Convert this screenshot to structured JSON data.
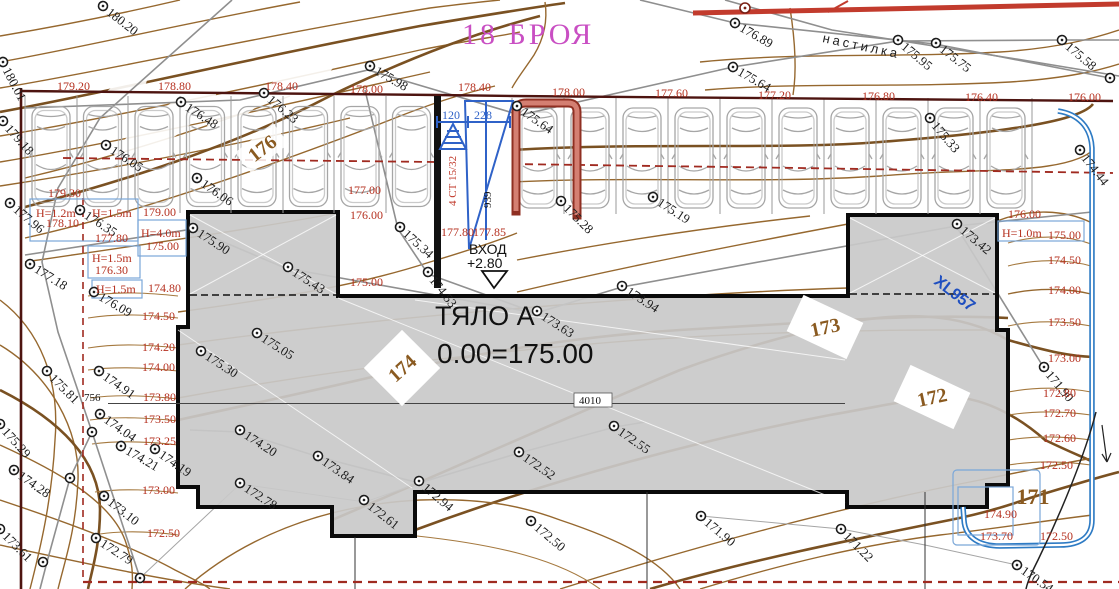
{
  "title": {
    "text": "18 БРОЯ"
  },
  "building": {
    "name": "ТЯЛО А",
    "level": "0.00=175.00",
    "entrance_label": "ВХОД",
    "entrance_height": "+2.80"
  },
  "paving_label": "настилка",
  "cable_label": "XL957",
  "crane": {
    "dim_left": "120",
    "dim_right": "228",
    "type_text": "4 СТ 15/32",
    "length": "939"
  },
  "dimensions": {
    "d756": "756",
    "d4010": "4010"
  },
  "colors": {
    "contour": "#96682f",
    "contour_index": "#7a5122",
    "red_label": "#b5301f",
    "boundary": "#4d1410",
    "dashed_red": "#a02a20",
    "blue": "#2f62c8",
    "pipe_blue": "#2e7bc4",
    "magenta": "#c94fc3",
    "building_fill": "#c9c9c9",
    "survey_gray": "#8f8f8f",
    "brown_label": "#8a5a20",
    "stair_red": "#c96a5a"
  },
  "index_labels": [
    {
      "t": "176",
      "x": 262,
      "y": 148,
      "r": -38,
      "fs": 20,
      "bg": "none"
    },
    {
      "t": "174",
      "x": 402,
      "y": 368,
      "r": -42,
      "fs": 20,
      "bg": "diamond45"
    },
    {
      "t": "173",
      "x": 825,
      "y": 327,
      "r": -12,
      "fs": 20,
      "bg": "diamond25"
    },
    {
      "t": "172",
      "x": 932,
      "y": 397,
      "r": -12,
      "fs": 20,
      "bg": "diamond25"
    },
    {
      "t": "171",
      "x": 1033,
      "y": 497,
      "r": 0,
      "fs": 22,
      "bg": "none"
    }
  ],
  "spot_elevations": [
    {
      "t": "180.20",
      "x": 103,
      "y": 6,
      "r": 38
    },
    {
      "t": "180.01",
      "x": 3,
      "y": 62,
      "r": 62
    },
    {
      "t": "179.18",
      "x": 3,
      "y": 121,
      "r": 48
    },
    {
      "t": "177.96",
      "x": 10,
      "y": 203,
      "r": 40
    },
    {
      "t": "177.18",
      "x": 30,
      "y": 264,
      "r": 32
    },
    {
      "t": "176.35",
      "x": 80,
      "y": 210,
      "r": 33
    },
    {
      "t": "176.09",
      "x": 94,
      "y": 292,
      "r": 30
    },
    {
      "t": "175.98",
      "x": 370,
      "y": 66,
      "r": 30
    },
    {
      "t": "176.48",
      "x": 181,
      "y": 102,
      "r": 33
    },
    {
      "t": "176.23",
      "x": 264,
      "y": 93,
      "r": 40
    },
    {
      "t": "176.05",
      "x": 106,
      "y": 145,
      "r": 33
    },
    {
      "t": "176.06",
      "x": 197,
      "y": 178,
      "r": 35
    },
    {
      "t": "175.64",
      "x": 517,
      "y": 106,
      "r": 35
    },
    {
      "t": "176.89",
      "x": 735,
      "y": 23,
      "r": 30
    },
    {
      "t": "175.64",
      "x": 733,
      "y": 67,
      "r": 30
    },
    {
      "t": "175.95",
      "x": 898,
      "y": 40,
      "r": 40
    },
    {
      "t": "175.75",
      "x": 936,
      "y": 43,
      "r": 38
    },
    {
      "t": "175.58",
      "x": 1062,
      "y": 40,
      "r": 40
    },
    {
      "t": "175.33",
      "x": 930,
      "y": 118,
      "r": 50
    },
    {
      "t": "174.44",
      "x": 1080,
      "y": 150,
      "r": 52
    },
    {
      "t": "175.90",
      "x": 193,
      "y": 228,
      "r": 33
    },
    {
      "t": "175.43",
      "x": 288,
      "y": 267,
      "r": 33
    },
    {
      "t": "175.34",
      "x": 400,
      "y": 227,
      "r": 42
    },
    {
      "t": "174.53",
      "x": 428,
      "y": 272,
      "r": 52
    },
    {
      "t": "175.28",
      "x": 561,
      "y": 201,
      "r": 45
    },
    {
      "t": "175.19",
      "x": 653,
      "y": 197,
      "r": 33
    },
    {
      "t": "173.94",
      "x": 622,
      "y": 286,
      "r": 33
    },
    {
      "t": "173.63",
      "x": 537,
      "y": 311,
      "r": 33
    },
    {
      "t": "173.42",
      "x": 957,
      "y": 224,
      "r": 40
    },
    {
      "t": "171.90",
      "x": 1044,
      "y": 367,
      "r": 50
    },
    {
      "t": "175.30",
      "x": 201,
      "y": 351,
      "r": 33
    },
    {
      "t": "175.05",
      "x": 257,
      "y": 333,
      "r": 33
    },
    {
      "t": "175.81",
      "x": 47,
      "y": 371,
      "r": 45
    },
    {
      "t": "174.91",
      "x": 99,
      "y": 371,
      "r": 35
    },
    {
      "t": "174.04",
      "x": 100,
      "y": 414,
      "r": 35
    },
    {
      "t": "174.21",
      "x": 121,
      "y": 446,
      "r": 30
    },
    {
      "t": "174.19",
      "x": 155,
      "y": 449,
      "r": 35
    },
    {
      "t": "175.29",
      "x": 0,
      "y": 424,
      "r": 48
    },
    {
      "t": "174.28",
      "x": 14,
      "y": 470,
      "r": 35
    },
    {
      "t": "173.61",
      "x": 0,
      "y": 529,
      "r": 45
    },
    {
      "t": "173.10",
      "x": 104,
      "y": 496,
      "r": 38
    },
    {
      "t": "172.79",
      "x": 96,
      "y": 538,
      "r": 33
    },
    {
      "t": "174.20",
      "x": 240,
      "y": 430,
      "r": 33
    },
    {
      "t": "173.84",
      "x": 318,
      "y": 456,
      "r": 35
    },
    {
      "t": "172.78",
      "x": 240,
      "y": 483,
      "r": 33
    },
    {
      "t": "172.61",
      "x": 364,
      "y": 500,
      "r": 38
    },
    {
      "t": "172.94",
      "x": 419,
      "y": 481,
      "r": 40
    },
    {
      "t": "172.55",
      "x": 614,
      "y": 426,
      "r": 35
    },
    {
      "t": "172.52",
      "x": 519,
      "y": 452,
      "r": 35
    },
    {
      "t": "172.50",
      "x": 531,
      "y": 521,
      "r": 40
    },
    {
      "t": "171.90",
      "x": 701,
      "y": 516,
      "r": 40
    },
    {
      "t": "171.22",
      "x": 841,
      "y": 529,
      "r": 45
    },
    {
      "t": "170.54",
      "x": 1017,
      "y": 565,
      "r": 35
    }
  ],
  "extra_markers": [
    {
      "x": 1110,
      "y": 78
    },
    {
      "x": 43,
      "y": 562
    },
    {
      "x": 92,
      "y": 432
    },
    {
      "x": 70,
      "y": 478
    },
    {
      "x": 140,
      "y": 578
    }
  ],
  "contour_labels": [
    {
      "t": "179.20",
      "x": 57,
      "y": 90
    },
    {
      "t": "178.80",
      "x": 158,
      "y": 90
    },
    {
      "t": "178.40",
      "x": 265,
      "y": 90
    },
    {
      "t": "178.00",
      "x": 350,
      "y": 93
    },
    {
      "t": "178.40",
      "x": 458,
      "y": 91
    },
    {
      "t": "178.00",
      "x": 552,
      "y": 96
    },
    {
      "t": "177.60",
      "x": 655,
      "y": 97
    },
    {
      "t": "177.20",
      "x": 758,
      "y": 99
    },
    {
      "t": "176.80",
      "x": 862,
      "y": 100
    },
    {
      "t": "176.40",
      "x": 965,
      "y": 101
    },
    {
      "t": "176.00",
      "x": 1068,
      "y": 101
    },
    {
      "t": "179.30",
      "x": 48,
      "y": 197
    },
    {
      "t": "177.00",
      "x": 348,
      "y": 194
    },
    {
      "t": "176.00",
      "x": 350,
      "y": 219
    },
    {
      "t": "175.00",
      "x": 350,
      "y": 286
    },
    {
      "t": "177.80",
      "x": 441,
      "y": 236
    },
    {
      "t": "177.85",
      "x": 473,
      "y": 236
    },
    {
      "t": "179.00",
      "x": 143,
      "y": 216
    },
    {
      "t": "175.00",
      "x": 146,
      "y": 250
    },
    {
      "t": "174.80",
      "x": 148,
      "y": 292
    },
    {
      "t": "174.50",
      "x": 142,
      "y": 320
    },
    {
      "t": "174.20",
      "x": 142,
      "y": 351
    },
    {
      "t": "174.00",
      "x": 142,
      "y": 371
    },
    {
      "t": "173.80",
      "x": 143,
      "y": 401
    },
    {
      "t": "173.50",
      "x": 143,
      "y": 423
    },
    {
      "t": "173.25",
      "x": 143,
      "y": 445
    },
    {
      "t": "173.00",
      "x": 142,
      "y": 494
    },
    {
      "t": "172.50",
      "x": 147,
      "y": 537
    },
    {
      "t": "178.10",
      "x": 46,
      "y": 227
    },
    {
      "t": "177.80",
      "x": 95,
      "y": 242
    },
    {
      "t": "176.30",
      "x": 95,
      "y": 274
    },
    {
      "t": "176.00",
      "x": 1008,
      "y": 218
    },
    {
      "t": "175.00",
      "x": 1048,
      "y": 239
    },
    {
      "t": "174.50",
      "x": 1048,
      "y": 264
    },
    {
      "t": "174.00",
      "x": 1048,
      "y": 294
    },
    {
      "t": "173.50",
      "x": 1048,
      "y": 326
    },
    {
      "t": "173.00",
      "x": 1048,
      "y": 362
    },
    {
      "t": "172.80",
      "x": 1043,
      "y": 397
    },
    {
      "t": "172.70",
      "x": 1043,
      "y": 417
    },
    {
      "t": "172.60",
      "x": 1043,
      "y": 442
    },
    {
      "t": "172.50",
      "x": 1040,
      "y": 469
    },
    {
      "t": "174.90",
      "x": 984,
      "y": 518
    },
    {
      "t": "173.70",
      "x": 980,
      "y": 540
    },
    {
      "t": "172.50",
      "x": 1040,
      "y": 540
    }
  ],
  "wall_labels": [
    {
      "t": "H=1.2m",
      "x": 36,
      "y": 217
    },
    {
      "t": "H=1.5m",
      "x": 92,
      "y": 217
    },
    {
      "t": "H=4.0m",
      "x": 141,
      "y": 237
    },
    {
      "t": "H=1.5m",
      "x": 92,
      "y": 262
    },
    {
      "t": "H=1.5m",
      "x": 96,
      "y": 293
    },
    {
      "t": "H=1.0m",
      "x": 1002,
      "y": 237
    }
  ]
}
